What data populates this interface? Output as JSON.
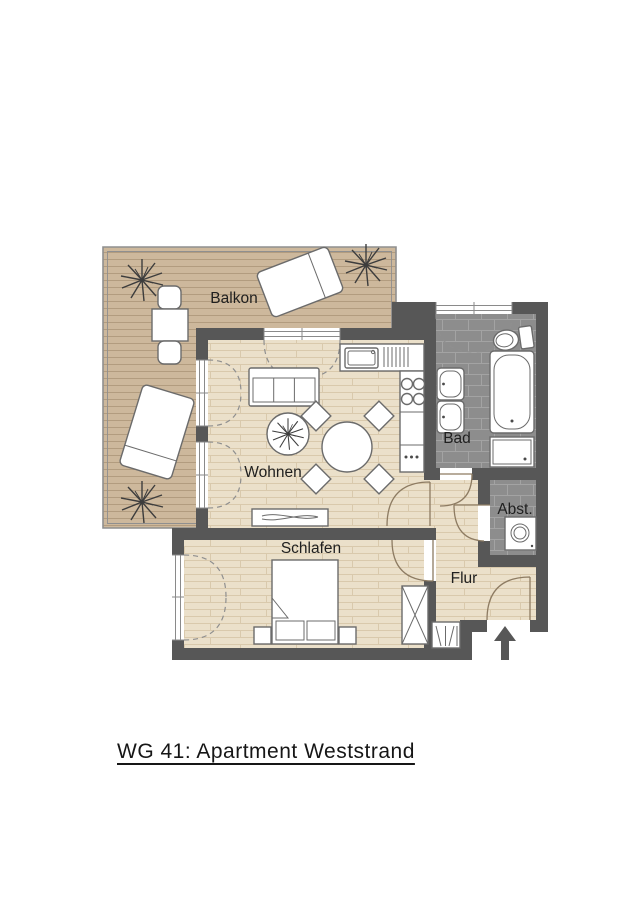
{
  "title": "WG 41: Apartment Weststrand",
  "rooms": {
    "balkon": "Balkon",
    "wohnen": "Wohnen",
    "bad": "Bad",
    "abst": "Abst.",
    "flur": "Flur",
    "schlafen": "Schlafen"
  },
  "icons": {
    "entrance-arrow-icon": "↑",
    "plant-icon": "✳",
    "washing-machine-icon": "◎"
  },
  "colors": {
    "wall": "#575757",
    "deck": "#cdb89c",
    "deckline": "#b29c7f",
    "floor": "#ebe0ca",
    "floorline": "#d9c9ac",
    "tile": "#8d8d8d",
    "tileline": "#a3a3a3",
    "text": "#1f1f1f",
    "background": "#ffffff"
  }
}
